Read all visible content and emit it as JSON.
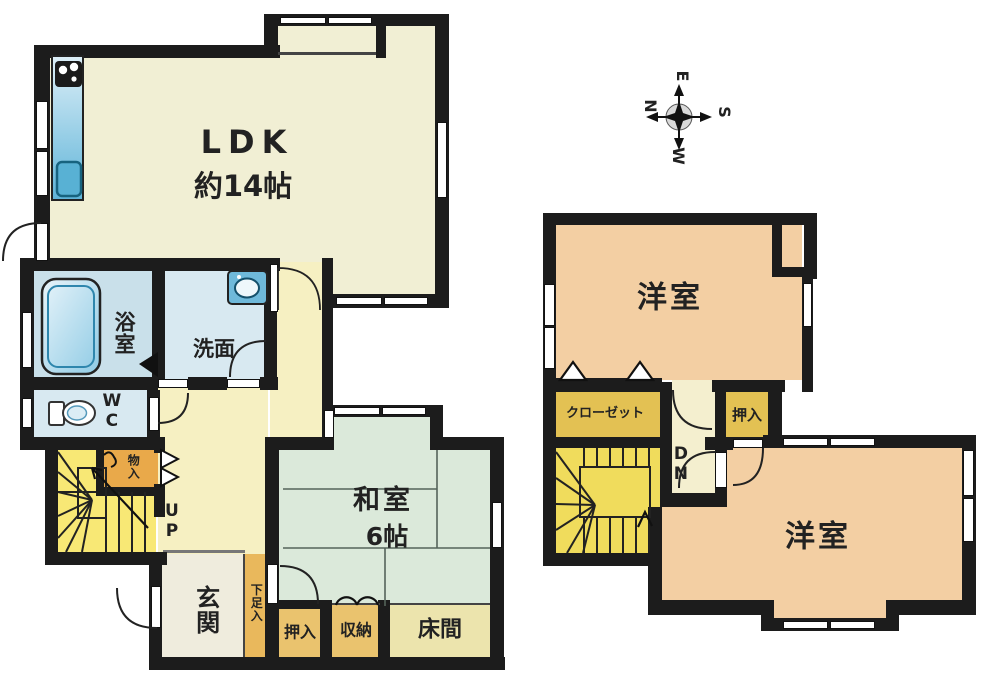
{
  "title": "2-story house floor plan",
  "floor1": {
    "ldk_label": "LDK",
    "ldk_size": "約14帖",
    "bath": "浴室",
    "washroom": "洗面",
    "wc": "WC",
    "storage_small": "物入",
    "stairs_up": "UP",
    "entrance": "玄関",
    "shoe_cabinet": "下足入",
    "tatami_room": "和室",
    "tatami_size": "6帖",
    "futon_closet": "押入",
    "storage": "収納",
    "alcove": "床間"
  },
  "floor2": {
    "western_room_1": "洋室",
    "closet": "クローゼット",
    "futon_closet": "押入",
    "stairs_down": "DN",
    "western_room_2": "洋室"
  },
  "compass": {
    "north": "N",
    "east": "E",
    "south": "S",
    "west": "W"
  },
  "palette": {
    "wall": "#1c1c1c",
    "ldk": "#f1efd4",
    "hall": "#f6f0c2",
    "entrance": "#efecdd",
    "bath": "#c9e0ea",
    "washroom": "#d8e9f1",
    "wc": "#d8e9f1",
    "stairs_1f": "#f8e875",
    "stairs_2f": "#f0dc5c",
    "storage_small": "#e9a94a",
    "shoe_cabinet": "#e9b85c",
    "tatami": "#dbe9da",
    "futon_closet": "#eac36e",
    "alcove": "#ece4ad",
    "western_room": "#f3cfa3",
    "closet_2f": "#e3c153",
    "hall_2f": "#f4efcf",
    "counter": "#7fc0dd",
    "compass_circle": "#d9d9d9"
  }
}
